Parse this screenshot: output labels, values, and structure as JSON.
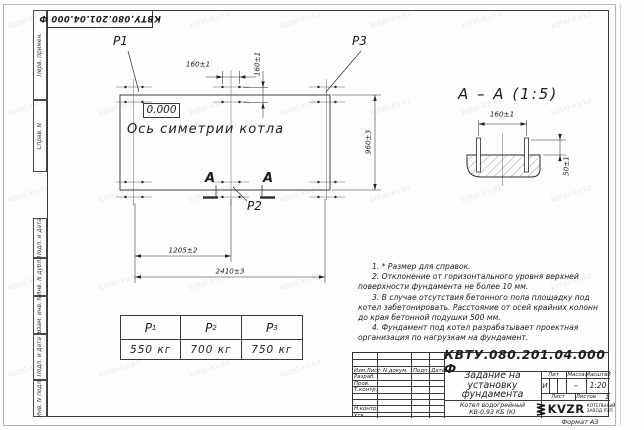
{
  "watermark": {
    "text": "kotel-kv.kz"
  },
  "sheet": {
    "top_stamp": "КВТУ.080.201.04.000  Ф",
    "margin_labels": [
      "Перв. примен.",
      "Справ. N",
      "Подп. и дата",
      "Инв. N дубл.",
      "Взам. инв. N",
      "Подп. и дата",
      "Инв. N подл."
    ],
    "format_note": "Формат А3"
  },
  "plan": {
    "p1": "P1",
    "p2": "P2",
    "p3": "P3",
    "level_mark": "0.000",
    "axis_label": "Ось симетрии котла",
    "section_letter": "А",
    "dims": {
      "bolt_h": "160±1",
      "bolt_v": "160±1",
      "height": "960±3",
      "half_width": "1205±2",
      "width": "2410±3"
    }
  },
  "section_view": {
    "title": "А – А (1:5)",
    "dims": {
      "bolt_spacing": "160±1",
      "protrusion": "50±1"
    }
  },
  "notes": {
    "lines": [
      "1. * Размер для справок.",
      "2. Отклонение от горизонтального уровня верхней поверхности фундамента не более 10 мм.",
      "3. В случае отсутствия бетонного пола площадку под котел забетонировать. Расстояние от осей крайних колонн до края бетонной подушки 500 мм.",
      "4. Фундамент под котел разрабатывает проектная организация по нагрузкам на фундамент."
    ]
  },
  "loads_table": {
    "columns": [
      {
        "name": "P",
        "sub": "1",
        "value": "550 кг"
      },
      {
        "name": "P",
        "sub": "2",
        "value": "700 кг"
      },
      {
        "name": "P",
        "sub": "3",
        "value": "750 кг"
      }
    ]
  },
  "title_block": {
    "doc_number": "КВТУ.080.201.04.000  Ф",
    "title_lines": [
      "Задание на",
      "установку",
      "фундамента"
    ],
    "product_lines": [
      "Котел водогрейный",
      "КВ-0,93 КБ (К)"
    ],
    "header_cols": [
      "Изм.Лист",
      "N докум.",
      "Подп.",
      "Дата"
    ],
    "sign_labels": [
      "Разраб.",
      "Пров.",
      "Т.контр.",
      "Н.контр.",
      "Утв."
    ],
    "lit": {
      "label": "Лит",
      "value": "И"
    },
    "mass": {
      "label": "Масса",
      "value": "–"
    },
    "scale": {
      "label": "Масштаб",
      "value": "1:20"
    },
    "sheet_no": {
      "label": "Лист"
    },
    "sheets": {
      "label": "Листов",
      "value": "1"
    },
    "logo": {
      "text": "KVZR",
      "caption_lines": [
        "КОТЕЛЬНЫЙ",
        "ЗАВОД РЭП"
      ]
    }
  }
}
